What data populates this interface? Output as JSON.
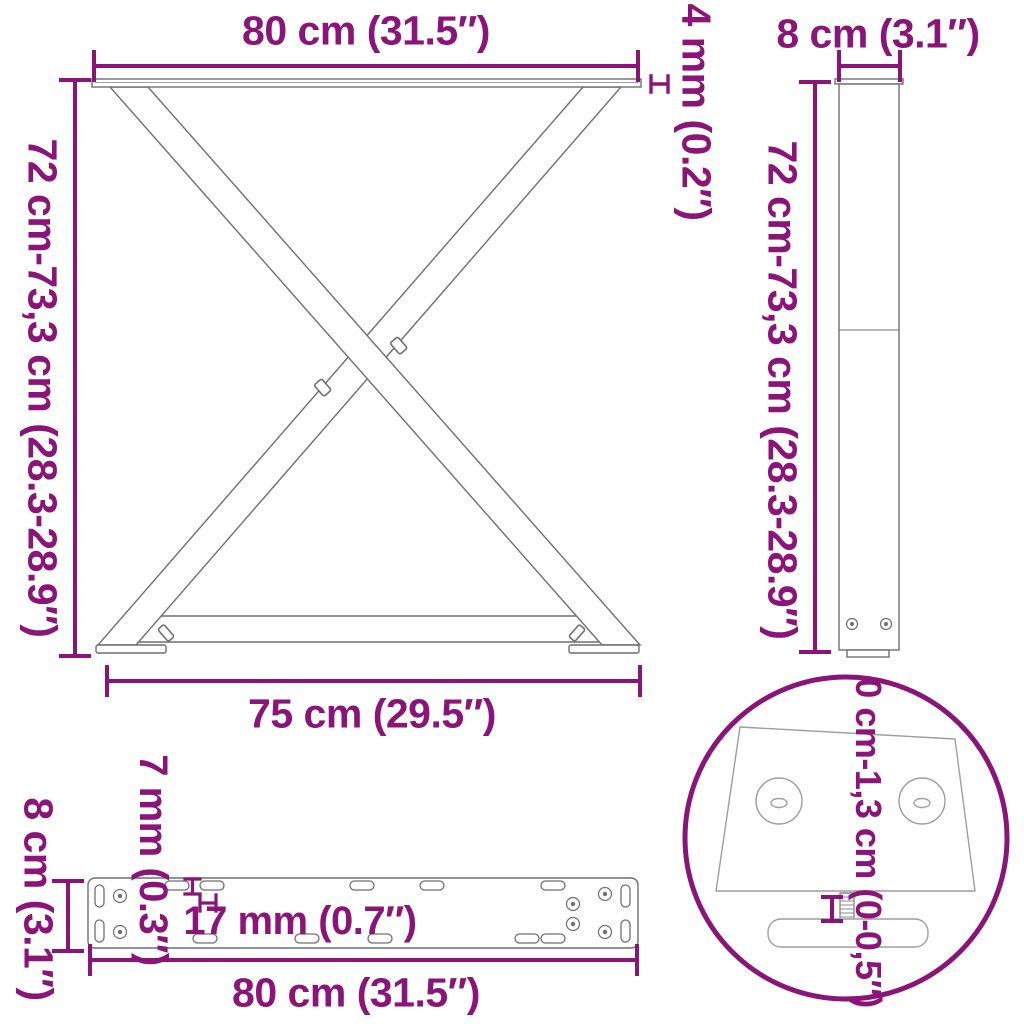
{
  "colors": {
    "dimension_accent": "#8a1477",
    "drawing_line": "#6f6f6f",
    "drawing_line_light": "#9e9e9e",
    "background": "#ffffff"
  },
  "front_view": {
    "width_top": "80 cm (31.5″)",
    "plate_thickness": "4 mm (0.2″)",
    "height_range": "72 cm-73,3 cm (28.3-28.9″)",
    "width_bottom": "75 cm (29.5″)"
  },
  "side_view": {
    "depth": "8 cm (3.1″)",
    "height_range": "72 cm-73,3 cm (28.3-28.9″)"
  },
  "plate_view": {
    "hole_diameter": "7 mm (0.3″)",
    "slot_length": "17 mm (0.7″)",
    "depth": "8 cm (3.1″)",
    "width": "80 cm (31.5″)"
  },
  "detail_view": {
    "adjustment_range": "0 cm-1,3 cm (0-0,5″)"
  }
}
